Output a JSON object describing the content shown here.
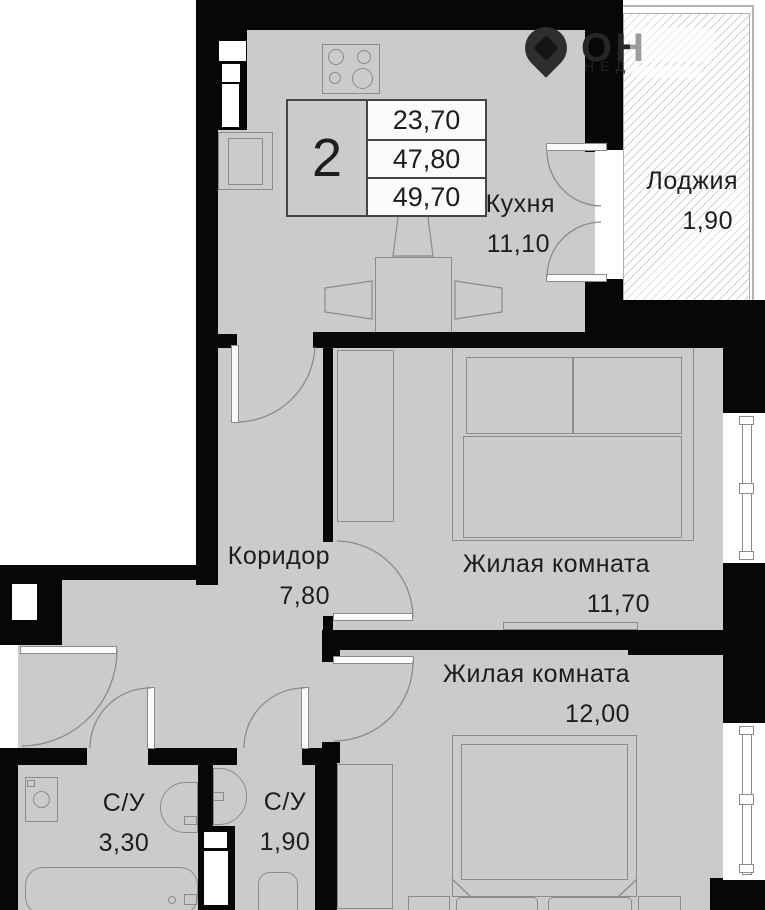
{
  "plan": {
    "unit_badge": "2",
    "info_rows": [
      "23,70",
      "47,80",
      "49,70"
    ],
    "rooms": {
      "kitchen": {
        "name": "Кухня",
        "area": "11,10"
      },
      "loggia": {
        "name": "Лоджия",
        "area": "1,90"
      },
      "corridor": {
        "name": "Коридор",
        "area": "7,80"
      },
      "living1": {
        "name": "Жилая комната",
        "area": "11,70"
      },
      "living2": {
        "name": "Жилая комната",
        "area": "12,00"
      },
      "bath1": {
        "name": "С/У",
        "area": "3,30"
      },
      "bath2": {
        "name": "С/У",
        "area": "1,90"
      }
    },
    "watermark": {
      "large": "ОН",
      "small": "НЕД"
    },
    "colors": {
      "wall": "#070707",
      "floor": "#cbcbca",
      "outline": "#8b8b8b",
      "text": "#1d1d1d"
    }
  }
}
